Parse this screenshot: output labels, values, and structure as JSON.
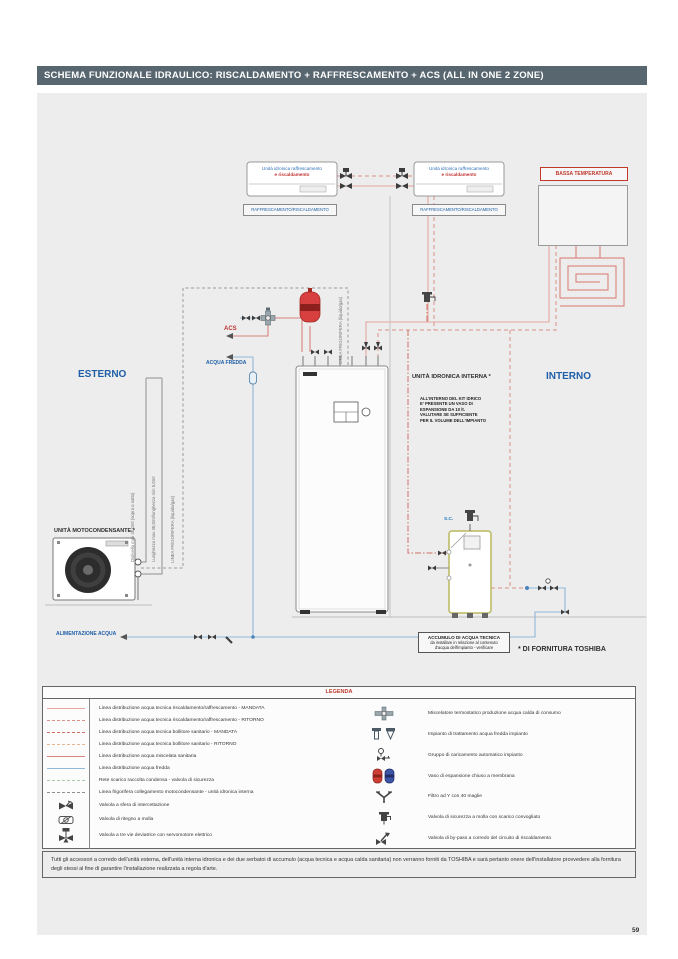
{
  "page": {
    "number": "59"
  },
  "header": {
    "title": "SCHEMA FUNZIONALE IDRAULICO: RISCALDAMENTO + RAFFRESCAMENTO + ACS (ALL IN ONE 2 ZONE)"
  },
  "colors": {
    "title_bar": "#57666f",
    "panel_bg": "#ededed",
    "blue_label": "#1f5fa8",
    "red_label": "#c0392b"
  },
  "diagram": {
    "fancoil_line1": "Unità idronica raffrescamento",
    "fancoil_line2": "e riscaldamento",
    "fancoil_mode": "RAFFRESCAMENTO/RISCALDAMENTO",
    "bassa_temperatura": "BASSA TEMPERATURA",
    "esterno": "ESTERNO",
    "interno": "INTERNO",
    "unita_idronica": "UNITÀ IDRONICA INTERNA *",
    "kit_note": "ALL'INTERNO DEL KIT IDRICO E' PRESENTE UN VASO DI ESPANSIONE DA 10 lt. VALUTARE SE SUFFICIENTE PER IL VOLUME DELL'IMPIANTO",
    "acs": "ACS",
    "acqua_fredda": "ACQUA FREDDA",
    "unita_motocondensante": "UNITÀ MOTOCONDENSANTE *",
    "alimentazione_acqua": "ALIMENTAZIONE ACQUA",
    "dislivello": "Dislivello max 30,0mt (sopra o sotto)",
    "lunghezza": "Lunghezza max 30,0mt/lunghezza min 5,0mt",
    "linea_frigorifera": "LINEA FRIGORIFERA (liquido/gas)",
    "sc": "S.C.",
    "accumulo_title": "ACCUMULO DI ACQUA TECNICA",
    "accumulo_line2": "da installare in relazione al contenuto",
    "accumulo_line3": "d'acqua dell'impianto - verificare",
    "fornitura": "* DI FORNITURA TOSHIBA"
  },
  "legend": {
    "title": "LEGENDA",
    "lines": [
      {
        "style": "solid",
        "color": "#e5a79f",
        "label": "Linea distribuzione acqua tecnica riscaldamento/raffrescamento - MANDATA"
      },
      {
        "style": "dashed",
        "color": "#dc9188",
        "label": "Linea distribuzione acqua tecnica riscaldamento/raffrescamento - RITORNO"
      },
      {
        "style": "dashdot",
        "color": "#cf6e62",
        "label": "Linea distribuzione acqua tecnica bollitore sanitario - MANDATA"
      },
      {
        "style": "dashed",
        "color": "#e6b693",
        "label": "Linea distribuzione acqua tecnica bollitore sanitario - RITORNO"
      },
      {
        "style": "solid",
        "color": "#d8837b",
        "label": "Linea distribuzione acqua miscelata sanitaria"
      },
      {
        "style": "solid",
        "color": "#90b9d9",
        "label": "Linea distribuzione acqua fredda"
      },
      {
        "style": "dashed",
        "color": "#a9cba9",
        "label": "Rete scarico raccolta condensa - valvola di sicurezza"
      },
      {
        "style": "dashed",
        "color": "#8f8f8f",
        "label": "Linea frigorifera collegamento motocondensante - unità idronica interna"
      }
    ],
    "symbols_left": [
      {
        "icon": "ball-valve",
        "label": "Valvola a sfera di intercettazione"
      },
      {
        "icon": "check-valve",
        "label": "Valvola di ritegno a molla"
      },
      {
        "icon": "three-way-valve",
        "label": "Valvola a tre vie deviatrice con servomotore elettrico"
      }
    ],
    "symbols_right": [
      {
        "icon": "thermostatic-mixer",
        "label": "Miscelatore termostatico produzione acqua calda di consumo"
      },
      {
        "icon": "water-treatment",
        "label": "Impianto di trattamento acqua fredda impianto"
      },
      {
        "icon": "auto-filling-group",
        "label": "Gruppo di caricamento automatico impianto"
      },
      {
        "icon": "expansion-vessel",
        "label": "Vaso di espansione chiuso a membrana"
      },
      {
        "icon": "y-filter",
        "label": "Filtro ad Y con 40 maglie"
      },
      {
        "icon": "safety-valve",
        "label": "Valvola di sicurezza a molla con scarico convogliato"
      },
      {
        "icon": "bypass-valve",
        "label": "Valvola di by-pass a corredo del circuito di riscaldamento"
      }
    ]
  },
  "footer": {
    "note": "Tutti gli accessori a corredo dell'unità esterna, dell'unità interna idronica e dei due serbatoi di accumulo (acqua tecnica e acqua calda sanitaria) non verranno forniti da TOSHIBA e sarà pertanto onere dell'installatore provvedere alla fornitura degli stessi al fine di garantire l'installazione realizzata a regola d'arte."
  }
}
